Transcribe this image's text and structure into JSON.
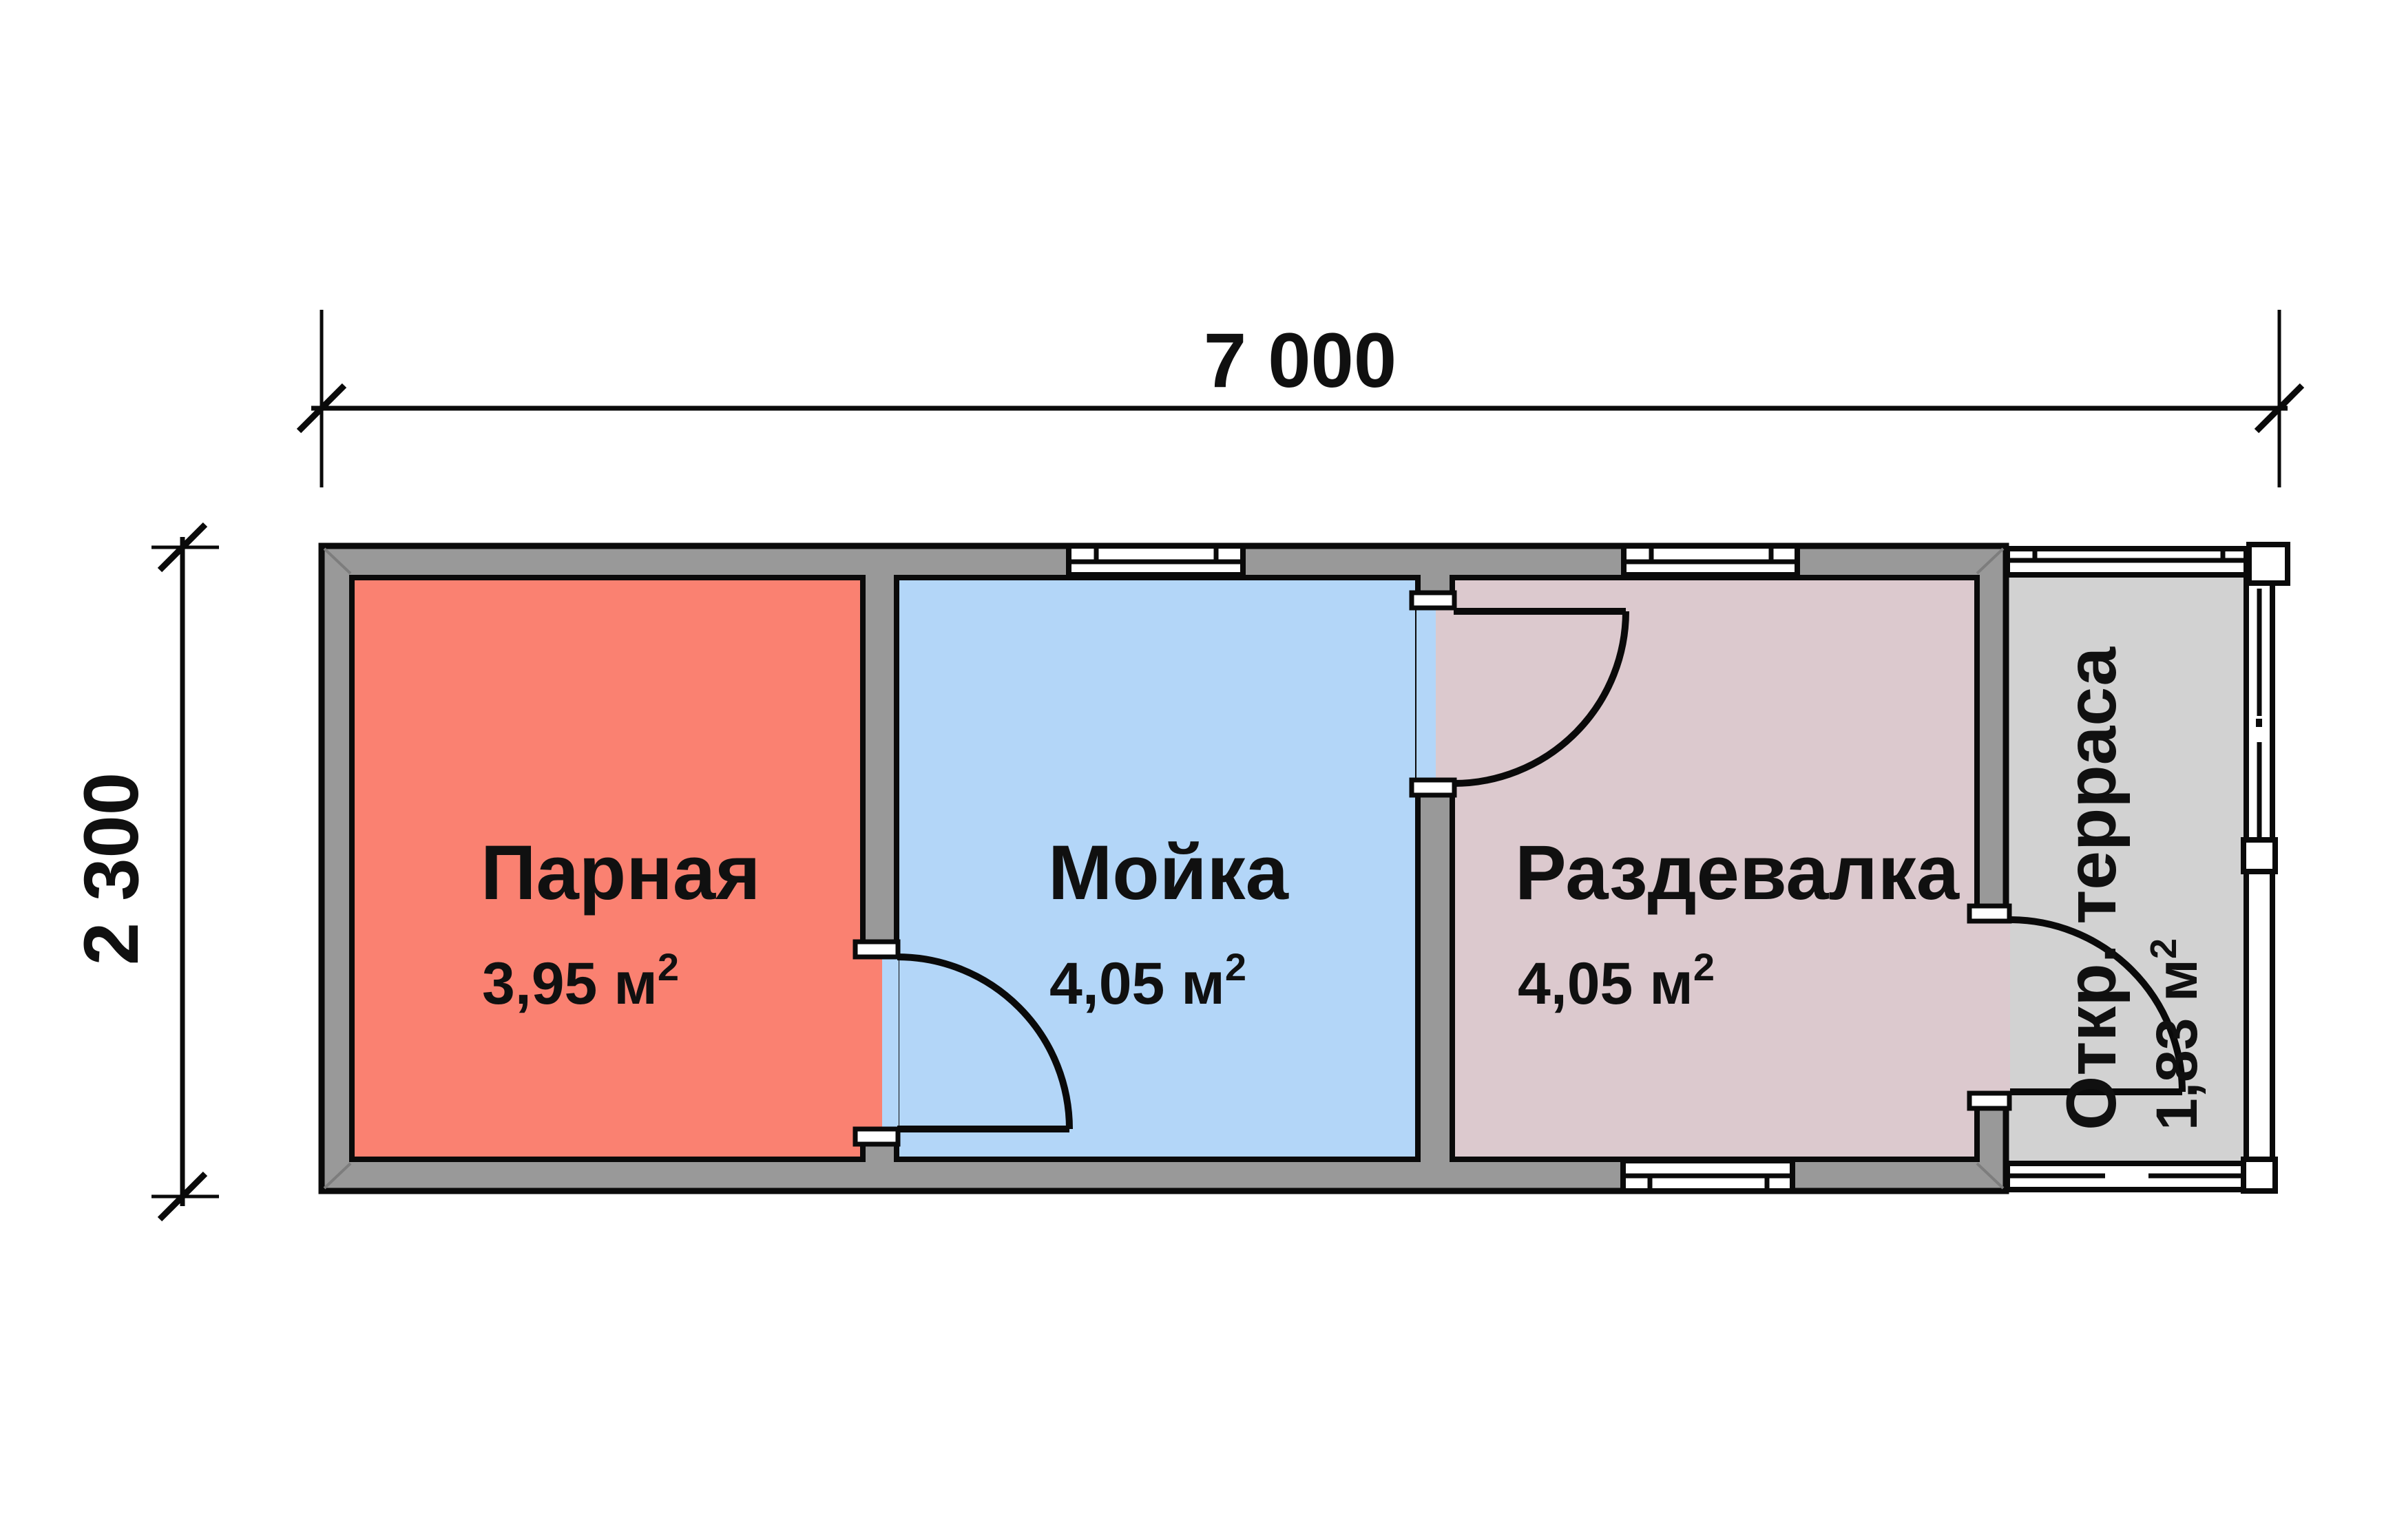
{
  "dimensions": {
    "width_label": "7 000",
    "height_label": "2 300"
  },
  "rooms": [
    {
      "name": "Парная",
      "area_main": "3,95 м",
      "area_sup": "2",
      "color": "#FA8171"
    },
    {
      "name": "Мойка",
      "area_main": "4,05 м",
      "area_sup": "2",
      "color": "#B3D6F8"
    },
    {
      "name": "Раздевалка",
      "area_main": "4,05 м",
      "area_sup": "2",
      "color": "#DCC9CE"
    },
    {
      "name": "Откр. терраса",
      "area_main": "1,83 м",
      "area_sup": "2",
      "color": "#D2D2D2"
    }
  ],
  "colors": {
    "wall_fill": "#999999",
    "outline": "#0a0a0a",
    "background": "#ffffff",
    "opening_white": "#ffffff"
  }
}
